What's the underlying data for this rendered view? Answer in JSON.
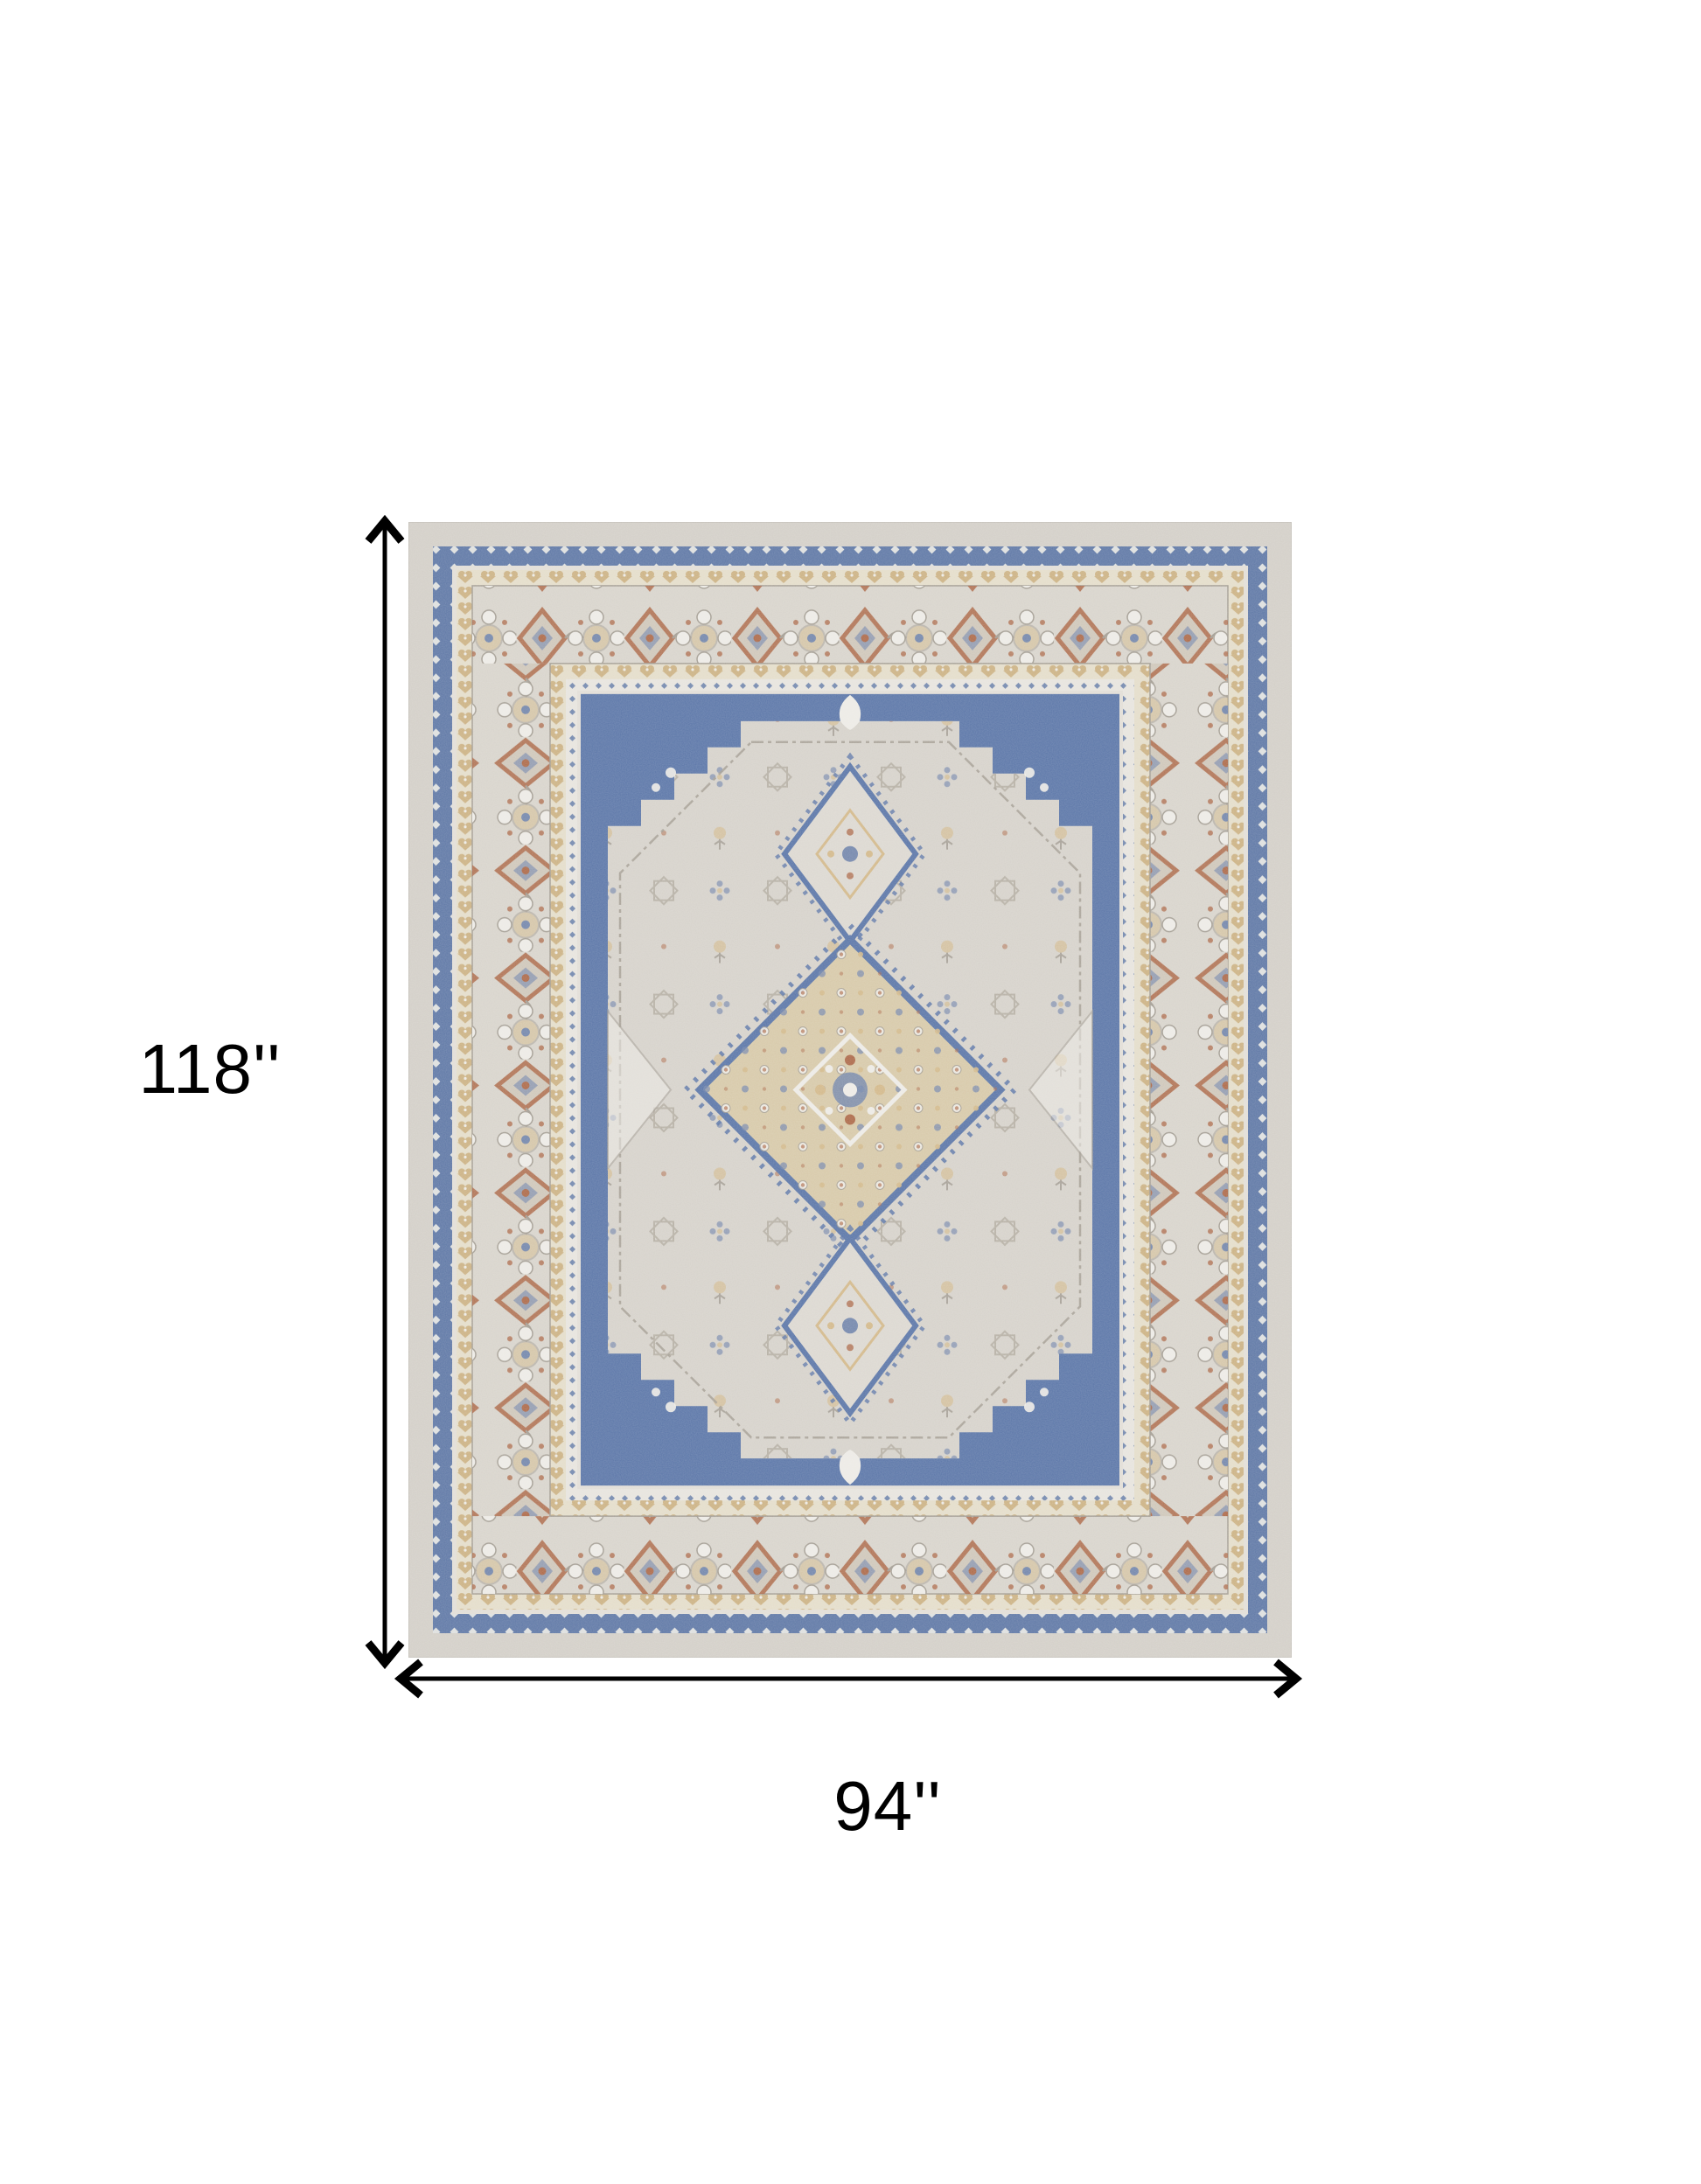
{
  "page": {
    "background_color": "#ffffff"
  },
  "annotations": {
    "height_label": "118''",
    "width_label": "94''",
    "arrow_color": "#000000",
    "label_color": "#000000"
  },
  "rug": {
    "palette": {
      "selvage": "#d3cfc8",
      "border_bg": "#d8d4cc",
      "band_blue": "#5f78a6",
      "band_tan_bg": "#e4ddca",
      "band_tan": "#ccb284",
      "check_bg": "#e7e4de",
      "motif_rust": "#ad6a4a",
      "motif_blue": "#7487ac",
      "motif_tan": "#d3b98b",
      "outline": "#a39d93",
      "field_gray": "#d6d2cb",
      "field_blue": "#5b76a8",
      "medallion_beige": "#d7c9a9",
      "accent_white": "#edebe6",
      "light_line": "#e2ded7"
    }
  }
}
